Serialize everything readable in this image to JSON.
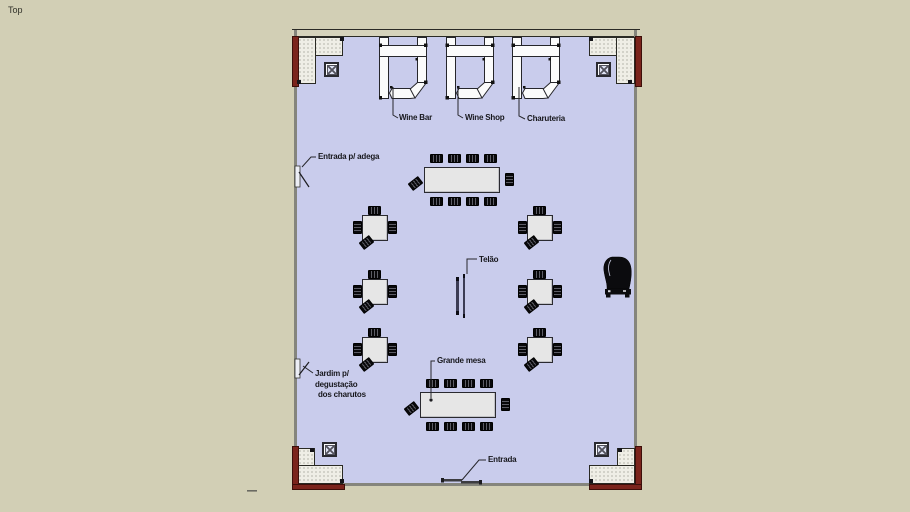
{
  "view": {
    "label": "Top"
  },
  "annotations": {
    "wine_bar": "Wine Bar",
    "wine_shop": "Wine Shop",
    "charuteria": "Charuteria",
    "entrada_adega": "Entrada p/ adega",
    "telao": "Telão",
    "grande_mesa": "Grande mesa",
    "jardim": {
      "line1": "Jardim p/",
      "line2": "degustação",
      "line3": "dos charutos"
    },
    "entrada": "Entrada"
  },
  "colors": {
    "background": "#d2cfb5",
    "floor": "#c9ccec",
    "wall_line": "#85857c",
    "top_wall_fill": "#d6d3bc",
    "planter_edge_red": "#7b241c",
    "outline": "#26262b",
    "table_fill": "#e6e6e6",
    "furniture_black": "#141418"
  }
}
